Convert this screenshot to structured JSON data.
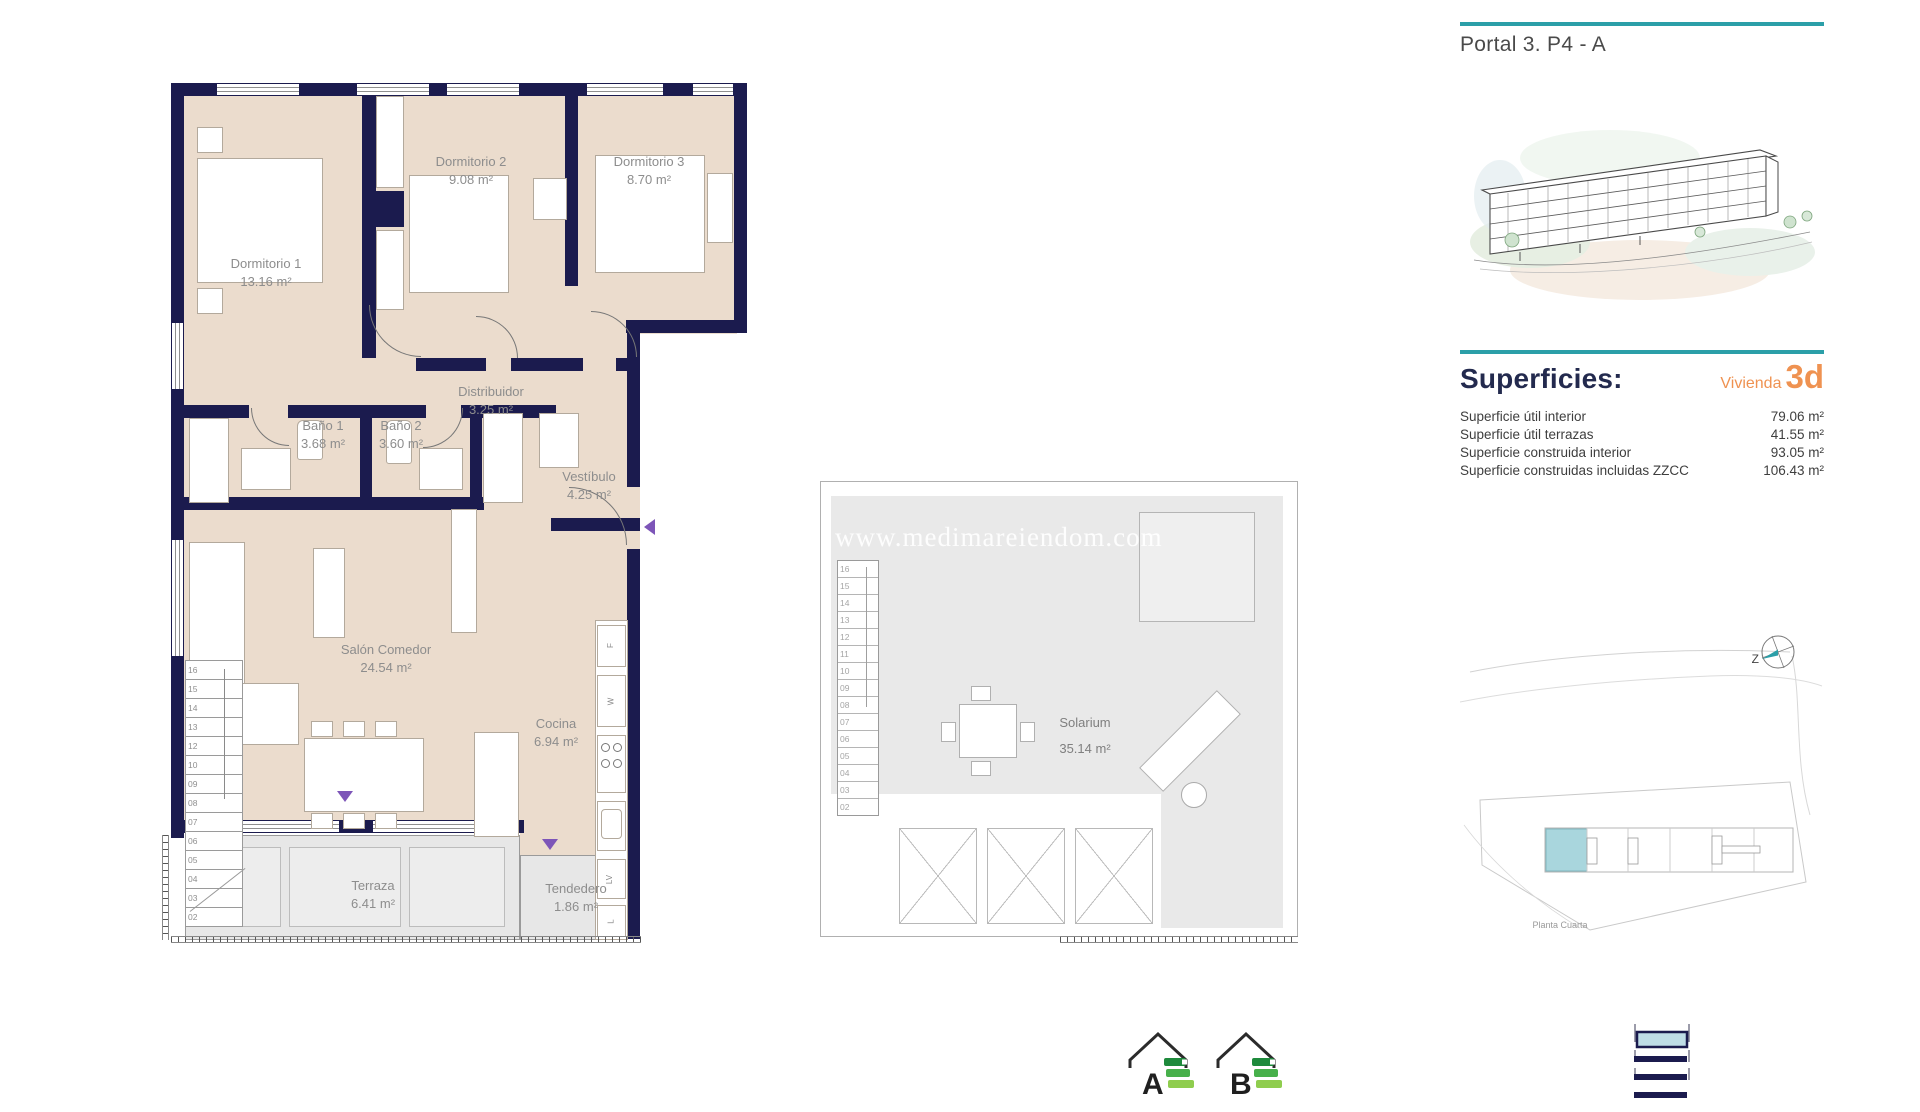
{
  "watermark": "www.medimareiendom.com",
  "sidebar": {
    "header": "Portal 3. P4 - A",
    "superficies_title": "Superficies:",
    "vivienda_label": "Vivienda",
    "vivienda_value": "3d",
    "surfaces": [
      {
        "label": "Superficie útil interior",
        "value": "79.06 m²"
      },
      {
        "label": "Superficie útil terrazas",
        "value": "41.55 m²"
      },
      {
        "label": "Superficie construida interior",
        "value": "93.05 m²"
      },
      {
        "label": "Superficie construidas incluidas ZZCC",
        "value": "106.43 m²"
      }
    ],
    "site_caption": "Planta Cuarta",
    "compass_letter": "Z"
  },
  "floor_plan": {
    "rooms": [
      {
        "name": "Dormitorio 1",
        "area": "13.16 m²"
      },
      {
        "name": "Dormitorio 2",
        "area": "9.08 m²"
      },
      {
        "name": "Dormitorio 3",
        "area": "8.70 m²"
      },
      {
        "name": "Distribuidor",
        "area": "3.25 m²"
      },
      {
        "name": "Baño 1",
        "area": "3.68 m²"
      },
      {
        "name": "Baño 2",
        "area": "3.60 m²"
      },
      {
        "name": "Vestíbulo",
        "area": "4.25 m²"
      },
      {
        "name": "Salón Comedor",
        "area": "24.54 m²"
      },
      {
        "name": "Cocina",
        "area": "6.94 m²"
      },
      {
        "name": "Terraza",
        "area": "6.41 m²"
      },
      {
        "name": "Tendedero",
        "area": "1.86 m²"
      }
    ],
    "stair_numbers": [
      "16",
      "15",
      "14",
      "13",
      "12",
      "10",
      "09",
      "08",
      "07",
      "06",
      "05",
      "04",
      "03",
      "02"
    ],
    "kitchen_labels": [
      "F",
      "W",
      "LV"
    ],
    "tendedero_label": "L"
  },
  "solarium": {
    "name": "Solarium",
    "area": "35.14 m²",
    "stair_numbers": [
      "16",
      "15",
      "14",
      "13",
      "12",
      "11",
      "10",
      "09",
      "08",
      "07",
      "06",
      "05",
      "04",
      "03",
      "02"
    ]
  },
  "footer": {
    "energy_left": "A",
    "energy_right": "B"
  },
  "colors": {
    "teal": "#2b9fa8",
    "orange": "#ef9251",
    "navy_wall": "#1b1b4e",
    "beige": "#ebdccd",
    "purple": "#7d55b8",
    "site_highlight": "#a9d6dd"
  }
}
